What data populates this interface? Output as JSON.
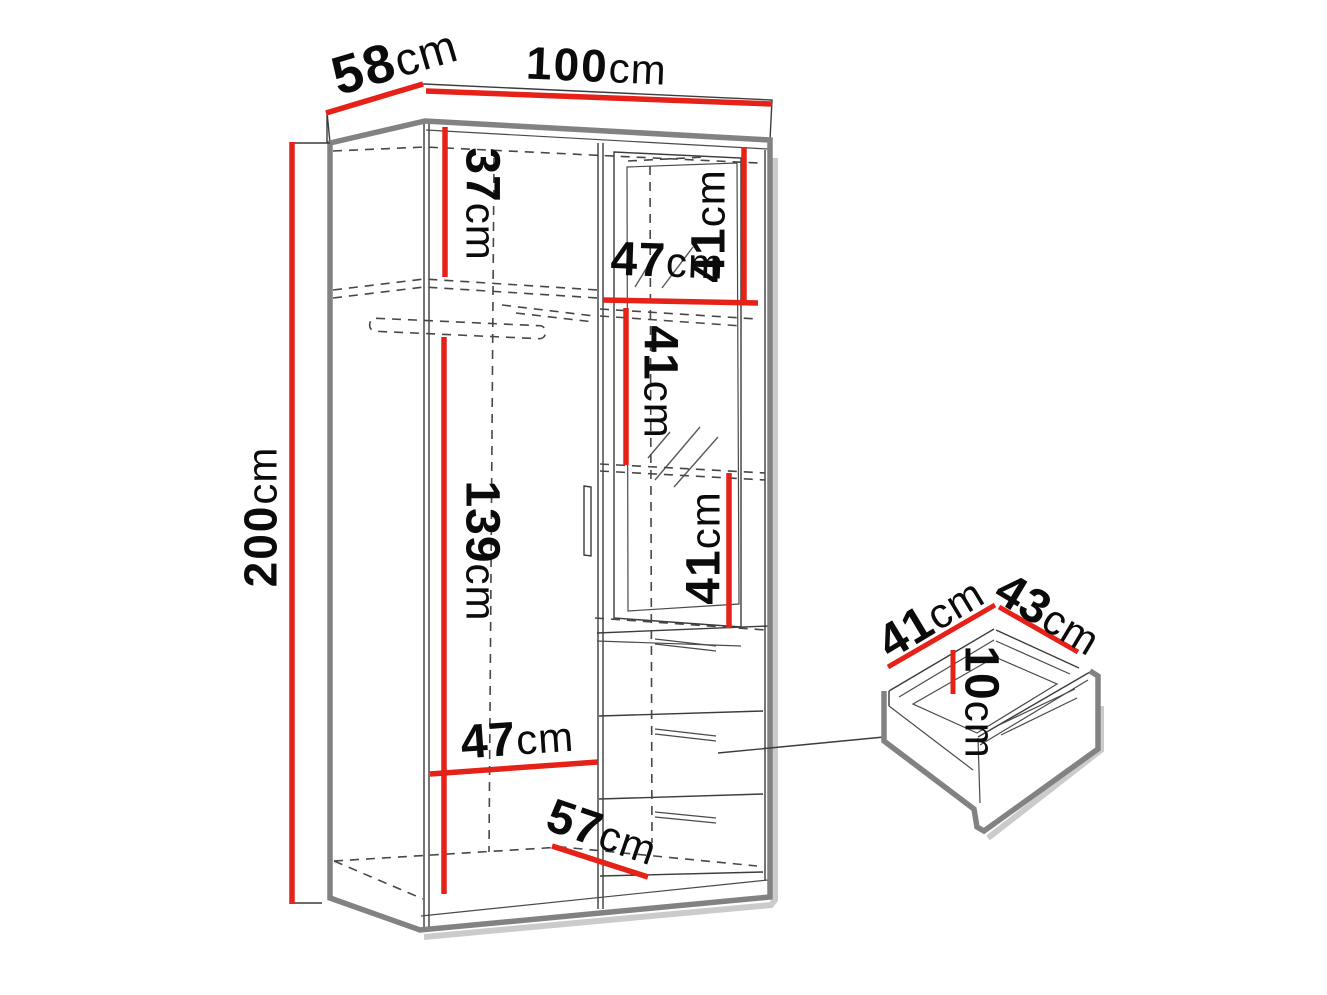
{
  "title": "Wardrobe dimension diagram",
  "colors": {
    "dimension_red": "#e52118",
    "outline_gray": "#828282",
    "line_dark": "#3c3c3c",
    "shadow_gray": "#cbcbcb",
    "text_black": "#0b0b0b",
    "background": "#ffffff"
  },
  "wardrobe": {
    "dimensions": {
      "depth_top": {
        "value": "58",
        "unit": "cm"
      },
      "width_top": {
        "value": "100",
        "unit": "cm"
      },
      "height_left": {
        "value": "200",
        "unit": "cm"
      },
      "upper_shelf_height": {
        "value": "37",
        "unit": "cm"
      },
      "left_section_height": {
        "value": "139",
        "unit": "cm"
      },
      "right_section_width": {
        "value": "47",
        "unit": "cm"
      },
      "right_top_height": {
        "value": "41",
        "unit": "cm"
      },
      "mirror_upper_height": {
        "value": "41",
        "unit": "cm"
      },
      "mirror_lower_height": {
        "value": "41",
        "unit": "cm"
      },
      "left_section_width": {
        "value": "47",
        "unit": "cm"
      },
      "interior_depth": {
        "value": "57",
        "unit": "cm"
      }
    }
  },
  "drawer": {
    "dimensions": {
      "depth": {
        "value": "41",
        "unit": "cm"
      },
      "width": {
        "value": "43",
        "unit": "cm"
      },
      "height": {
        "value": "10",
        "unit": "cm"
      }
    }
  }
}
